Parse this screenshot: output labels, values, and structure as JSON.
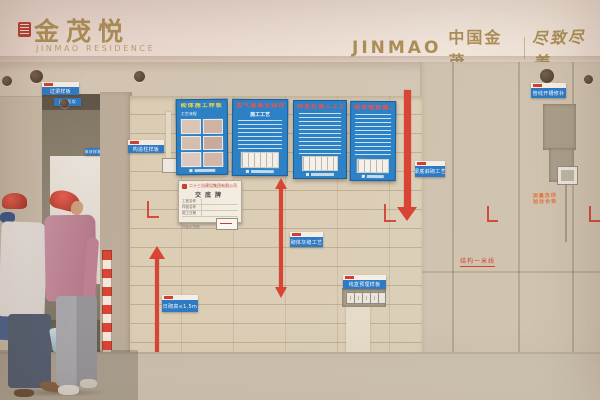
{
  "branding": {
    "left_cn": "金茂悦",
    "left_en": "JINMAO RESIDENCE",
    "right_en": "JINMAO",
    "right_cn": "中国金茂",
    "divider": "|",
    "slogan": "尽致尽美",
    "gold_color": "#a88c51",
    "seal_color": "#b5342c"
  },
  "posters": [
    {
      "title": "砌体施工样板",
      "caption": "工艺流程"
    },
    {
      "title": "加气混凝土砌块砌筑工艺",
      "subtitle": "施工工艺"
    },
    {
      "title": "构造柱施工工艺"
    },
    {
      "title": "砌体植筋施工工艺"
    }
  ],
  "placard": {
    "company": "二十三冶建设集团有限公司",
    "title": "交底牌",
    "rows": [
      {
        "label": "工程名称",
        "value": ""
      },
      {
        "label": "样板名称",
        "value": ""
      },
      {
        "label": "施工日期",
        "value": ""
      }
    ],
    "caption": "样板示意图"
  },
  "tags": [
    {
      "label": "过梁样板"
    },
    {
      "label": "构造柱样板"
    },
    {
      "label": "止水反坎"
    },
    {
      "label": "抹灰样板"
    },
    {
      "label": "梁底斜砌工艺"
    },
    {
      "label": "砌体灰缝工艺"
    },
    {
      "label": "日砌高≤1.5m"
    },
    {
      "label": "线盒预埋样板"
    },
    {
      "label": "管线开槽修补"
    },
    {
      "label": "墙体拉结筋"
    }
  ],
  "marks": {
    "stamp_line1": "测量放线",
    "stamp_line2": "验收合格",
    "one_meter_line": "结构一米线",
    "floor_stencil": "建筑完成面"
  },
  "colors": {
    "poster_blue": "#1b7cc9",
    "tag_blue": "#1e74c6",
    "arrow_red": "#d8392b"
  }
}
